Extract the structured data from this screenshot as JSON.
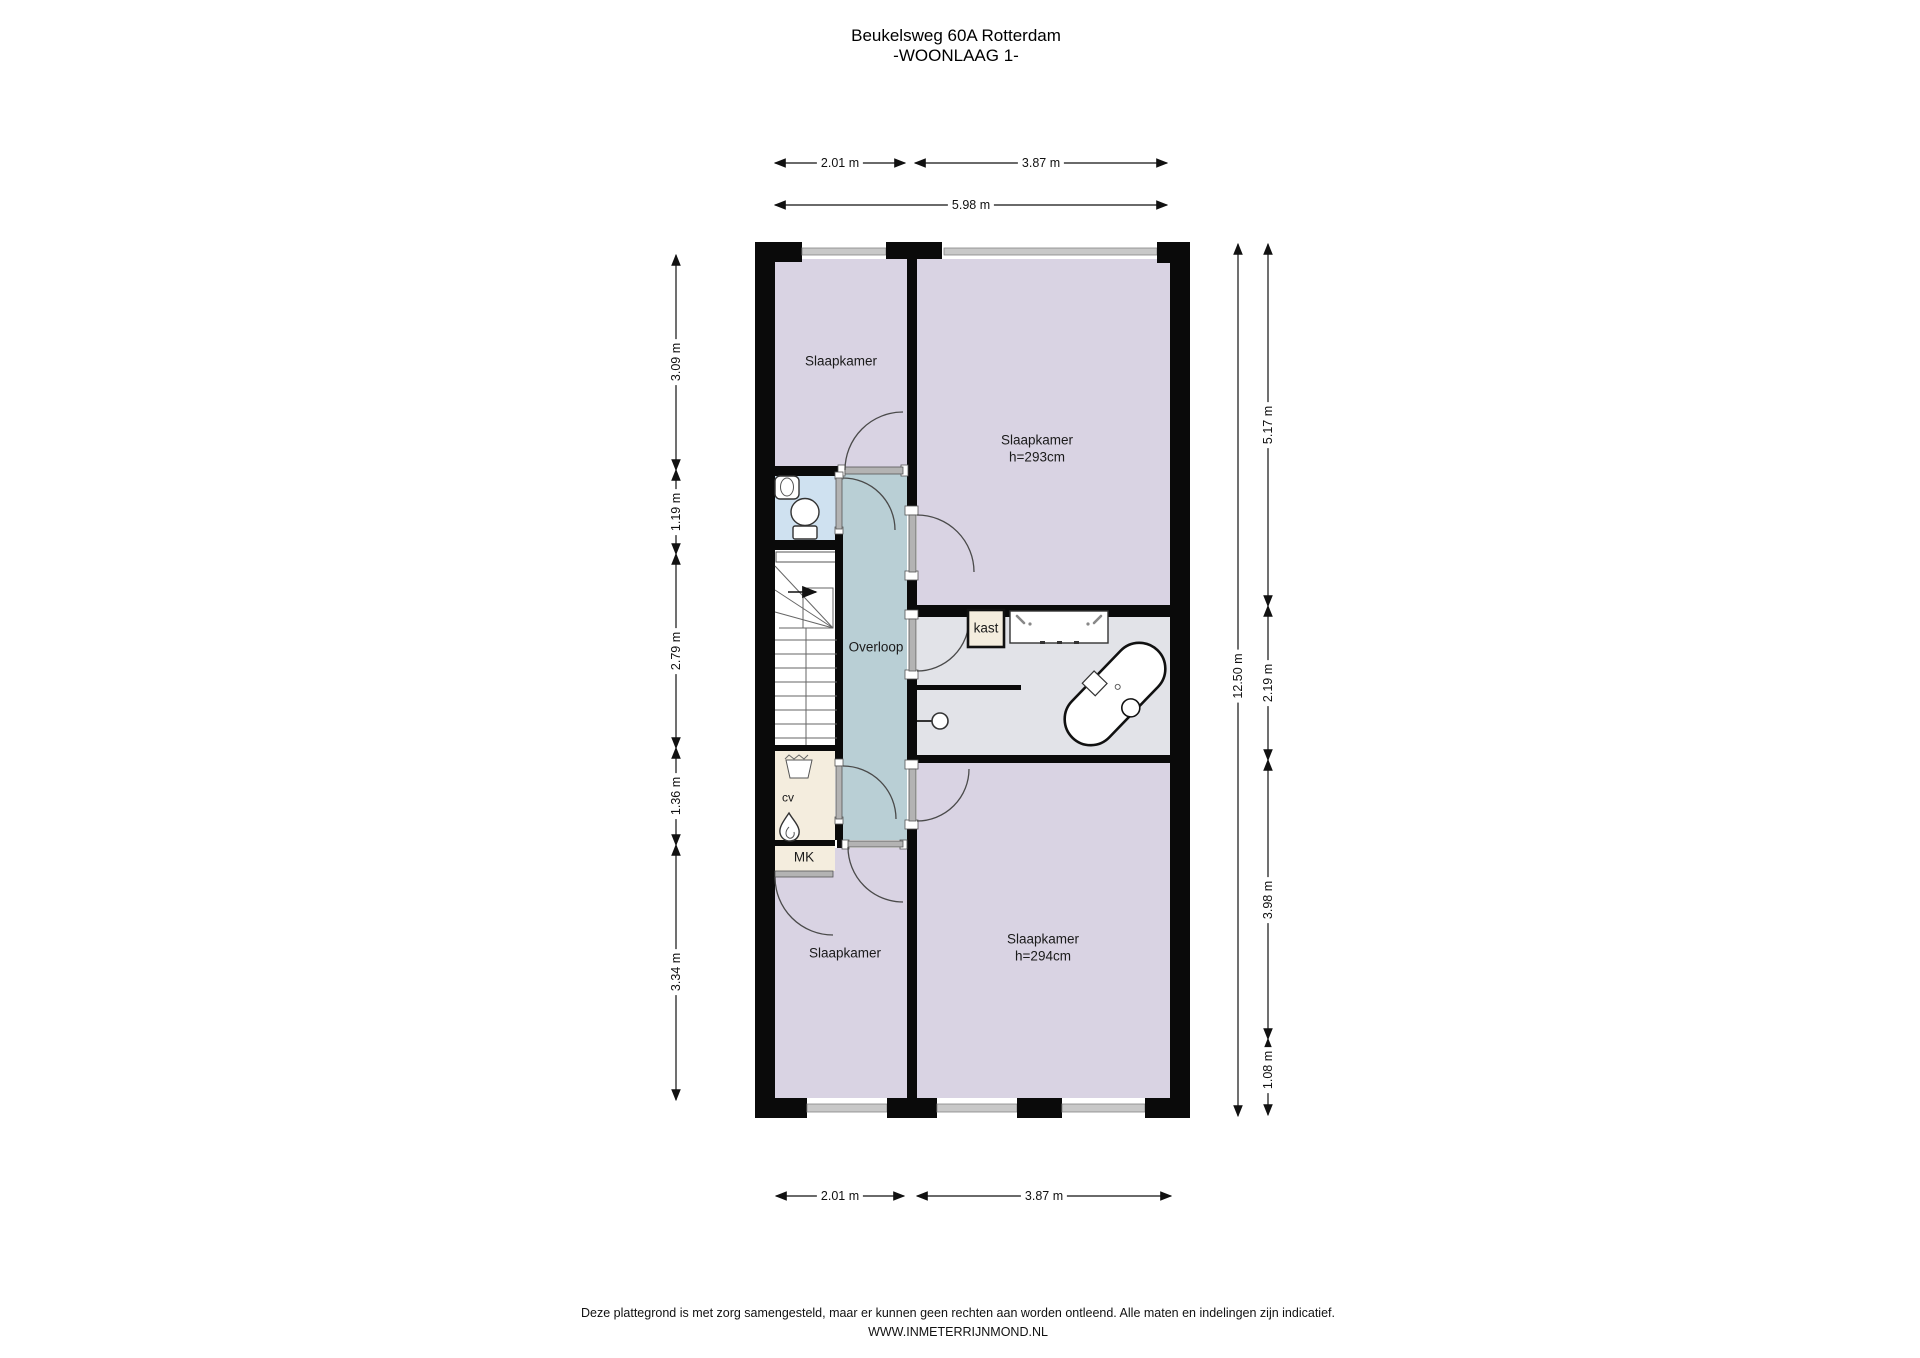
{
  "title": {
    "line1": "Beukelsweg 60A Rotterdam",
    "line2": "-WOONLAAG 1-"
  },
  "rooms": {
    "slaapkamer_top_left": {
      "label": "Slaapkamer"
    },
    "slaapkamer_top_right": {
      "label": "Slaapkamer",
      "ceiling_height": "h=293cm"
    },
    "overloop": {
      "label": "Overloop"
    },
    "kast": {
      "label": "kast"
    },
    "cv": {
      "label": "cv"
    },
    "meterkast": {
      "label": "MK"
    },
    "slaapkamer_bottom_left": {
      "label": "Slaapkamer"
    },
    "slaapkamer_bottom_right": {
      "label": "Slaapkamer",
      "ceiling_height": "h=294cm"
    }
  },
  "dimensions": {
    "top_row1": [
      {
        "value": "2.01 m"
      },
      {
        "value": "3.87 m"
      }
    ],
    "top_row2": [
      {
        "value": "5.98 m"
      }
    ],
    "bottom": [
      {
        "value": "2.01 m"
      },
      {
        "value": "3.87 m"
      }
    ],
    "left": [
      {
        "value": "3.09 m"
      },
      {
        "value": "1.19 m"
      },
      {
        "value": "2.79 m"
      },
      {
        "value": "1.36 m"
      },
      {
        "value": "3.34 m"
      }
    ],
    "right_outer": {
      "value": "12.50 m"
    },
    "right_inner": [
      {
        "value": "5.17 m"
      },
      {
        "value": "2.19 m"
      },
      {
        "value": "3.98 m"
      },
      {
        "value": "1.08 m"
      }
    ]
  },
  "footer": {
    "disclaimer": "Deze plattegrond is met zorg samengesteld, maar er kunnen geen rechten aan worden ontleend. Alle maten en indelingen zijn indicatief.",
    "website": "WWW.INMETERRIJNMOND.NL"
  },
  "colors": {
    "room-purple": "#d9d3e3",
    "hall-teal": "#b9cfd5",
    "toilet-blue": "#cfe1f0",
    "closet-beige": "#f4edde",
    "bath-gray": "#e2e3e8",
    "wall": "#0a0a0a",
    "window-gray": "#c8c8c8"
  }
}
